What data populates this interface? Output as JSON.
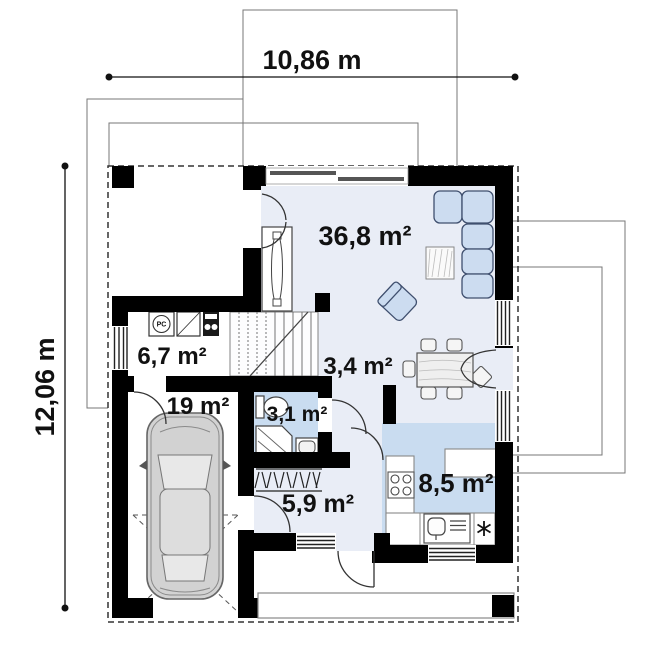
{
  "title": "house ground floor plan",
  "dimensions": {
    "width": "10,86 m",
    "height": "12,06 m"
  },
  "rooms": {
    "living": "36,8 m²",
    "utility": "6,7 m²",
    "hall": "3,4 m²",
    "garage": "19 m²",
    "bathroom": "3,1 m²",
    "entry": "5,9 m²",
    "kitchen": "8,5 m²"
  },
  "symbols": {
    "washer": "PC"
  },
  "colors": {
    "wall": "#000000",
    "floor_light": "#e9edf6",
    "floor_blue": "#c9dcf0",
    "furniture_blue": "#ccdcf0",
    "line": "#333333"
  }
}
